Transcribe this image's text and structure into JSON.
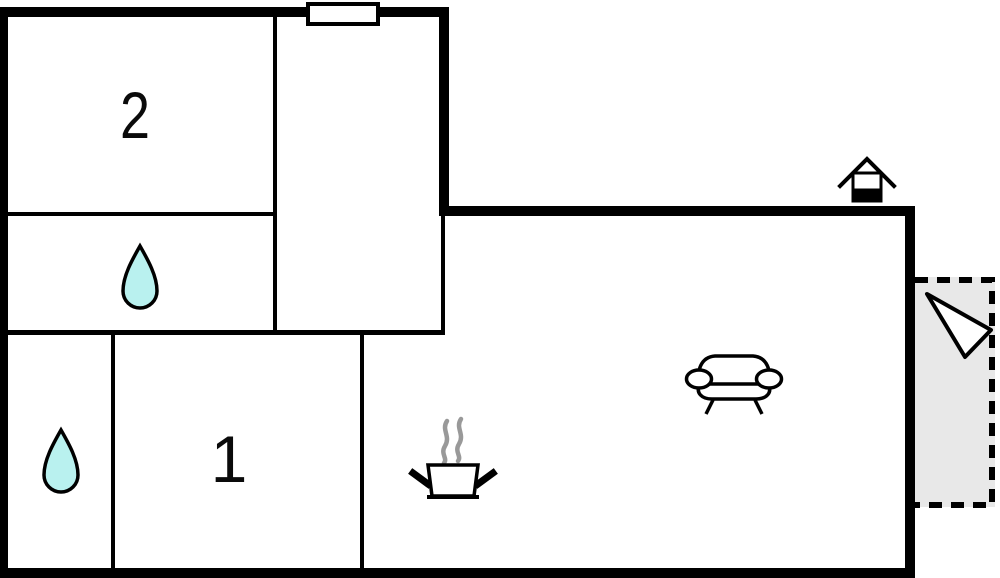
{
  "floorplan": {
    "type": "floor-plan",
    "rooms": {
      "room2": {
        "label": "2",
        "name": "bedroom-2"
      },
      "room1": {
        "label": "1",
        "name": "bedroom-1"
      },
      "bath_upper": {
        "name": "bathroom-upper",
        "icon": "water-drop-icon"
      },
      "bath_lower": {
        "name": "bathroom-lower",
        "icon": "water-drop-icon"
      },
      "hallway": {
        "name": "hallway"
      },
      "living_kitchen": {
        "name": "living-kitchen-area",
        "icons": [
          "stove-pot-icon",
          "sofa-icon"
        ]
      },
      "terrace": {
        "name": "terrace",
        "style": "dashed-outline",
        "icon": "entrance-arrow-icon"
      }
    },
    "icons": [
      "window-icon",
      "fireplace-chimney-icon",
      "water-drop-icon",
      "water-drop-icon",
      "stove-pot-icon",
      "sofa-icon",
      "entrance-arrow-icon"
    ],
    "colors": {
      "wall": "#000000",
      "background": "#ffffff",
      "water_drop": "#b9f1ef",
      "terrace_fill": "#e8e8e8",
      "steam": "#999999",
      "icon_fill": "#ffffff",
      "outline": "#000000"
    }
  }
}
